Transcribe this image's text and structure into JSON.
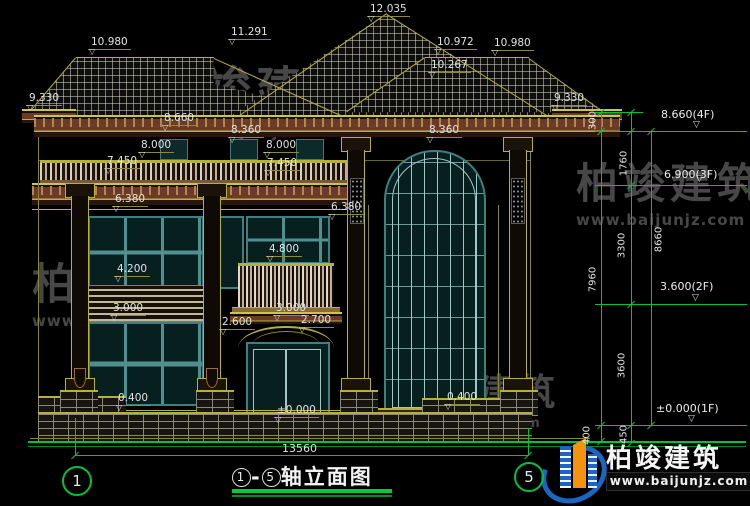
{
  "brand": {
    "name": "柏竣建筑",
    "url": "www.baijunjz.com"
  },
  "title_block": {
    "axis_from": "1",
    "dash": "-",
    "axis_to": "5",
    "title": "轴立面图"
  },
  "bottom_dimension": {
    "total": "13560"
  },
  "axis_bubbles": [
    {
      "n": "1",
      "x": 62,
      "y": 466
    },
    {
      "n": "5",
      "x": 514,
      "y": 462
    }
  ],
  "elevation_labels": [
    {
      "t": "10.980",
      "x": 88,
      "y": 37
    },
    {
      "t": "11.291",
      "x": 228,
      "y": 27
    },
    {
      "t": "12.035",
      "x": 367,
      "y": 4
    },
    {
      "t": "10.972",
      "x": 434,
      "y": 37
    },
    {
      "t": "10.980",
      "x": 491,
      "y": 38
    },
    {
      "t": "10.267",
      "x": 428,
      "y": 60
    },
    {
      "t": "9.330",
      "x": 26,
      "y": 93
    },
    {
      "t": "9.330",
      "x": 551,
      "y": 93
    },
    {
      "t": "8.660",
      "x": 161,
      "y": 113
    },
    {
      "t": "8.360",
      "x": 228,
      "y": 125
    },
    {
      "t": "8.360",
      "x": 426,
      "y": 125
    },
    {
      "t": "8.000",
      "x": 138,
      "y": 140
    },
    {
      "t": "8.000",
      "x": 263,
      "y": 140
    },
    {
      "t": "7.450",
      "x": 104,
      "y": 156
    },
    {
      "t": "7.450",
      "x": 264,
      "y": 158
    },
    {
      "t": "6.380",
      "x": 112,
      "y": 194
    },
    {
      "t": "6.380",
      "x": 328,
      "y": 202
    },
    {
      "t": "4.800",
      "x": 266,
      "y": 244
    },
    {
      "t": "4.200",
      "x": 114,
      "y": 264
    },
    {
      "t": "3.000",
      "x": 110,
      "y": 303
    },
    {
      "t": "3.000",
      "x": 273,
      "y": 303
    },
    {
      "t": "2.600",
      "x": 219,
      "y": 317
    },
    {
      "t": "2.700",
      "x": 298,
      "y": 315
    },
    {
      "t": "0.400",
      "x": 115,
      "y": 393
    },
    {
      "t": "0.400",
      "x": 444,
      "y": 392
    },
    {
      "t": "±0.000",
      "x": 274,
      "y": 405
    }
  ],
  "right_dimensions": {
    "levels": [
      {
        "t": "8.660(4F)",
        "x": 661,
        "y": 108,
        "ly": 131
      },
      {
        "t": "6.900(3F)",
        "x": 664,
        "y": 168,
        "ly": 185
      },
      {
        "t": "3.600(2F)",
        "x": 660,
        "y": 280,
        "ly": 304
      },
      {
        "t": "±0.000(1F)",
        "x": 656,
        "y": 402,
        "ly": 425
      }
    ],
    "segments": [
      {
        "t": "300",
        "x": 593,
        "y": 121
      },
      {
        "t": "1760",
        "x": 624,
        "y": 164
      },
      {
        "t": "3300",
        "x": 622,
        "y": 246
      },
      {
        "t": "8660",
        "x": 659,
        "y": 240
      },
      {
        "t": "7960",
        "x": 593,
        "y": 280
      },
      {
        "t": "3600",
        "x": 622,
        "y": 366
      },
      {
        "t": "450",
        "x": 624,
        "y": 435
      },
      {
        "t": "400",
        "x": 587,
        "y": 436
      }
    ],
    "vlines": [
      {
        "x": 601,
        "y1": 112,
        "y2": 441
      },
      {
        "x": 631,
        "y1": 112,
        "y2": 443
      },
      {
        "x": 651,
        "y1": 131,
        "y2": 425
      }
    ],
    "hlines": [
      {
        "x": 595,
        "y": 112,
        "w": 48
      },
      {
        "x": 595,
        "y": 131,
        "w": 152
      },
      {
        "x": 595,
        "y": 185,
        "w": 152
      },
      {
        "x": 595,
        "y": 304,
        "w": 152
      },
      {
        "x": 595,
        "y": 425,
        "w": 152
      }
    ],
    "ticks": [
      [
        601,
        112
      ],
      [
        601,
        131
      ],
      [
        601,
        425
      ],
      [
        601,
        441
      ],
      [
        631,
        112
      ],
      [
        631,
        131
      ],
      [
        631,
        185
      ],
      [
        631,
        304
      ],
      [
        631,
        425
      ],
      [
        631,
        443
      ],
      [
        651,
        131
      ],
      [
        651,
        425
      ]
    ]
  },
  "colors": {
    "cad_yellow": "#b5b13f",
    "cad_green": "#00c23e",
    "dim_text": "#e2e2e2",
    "window_frame": "#3f7f7f",
    "window_glass": "#081f1f",
    "cornice_maroon": "#6e3a28",
    "logo_blue": "#1a66c2",
    "logo_orange": "#f5930f"
  }
}
